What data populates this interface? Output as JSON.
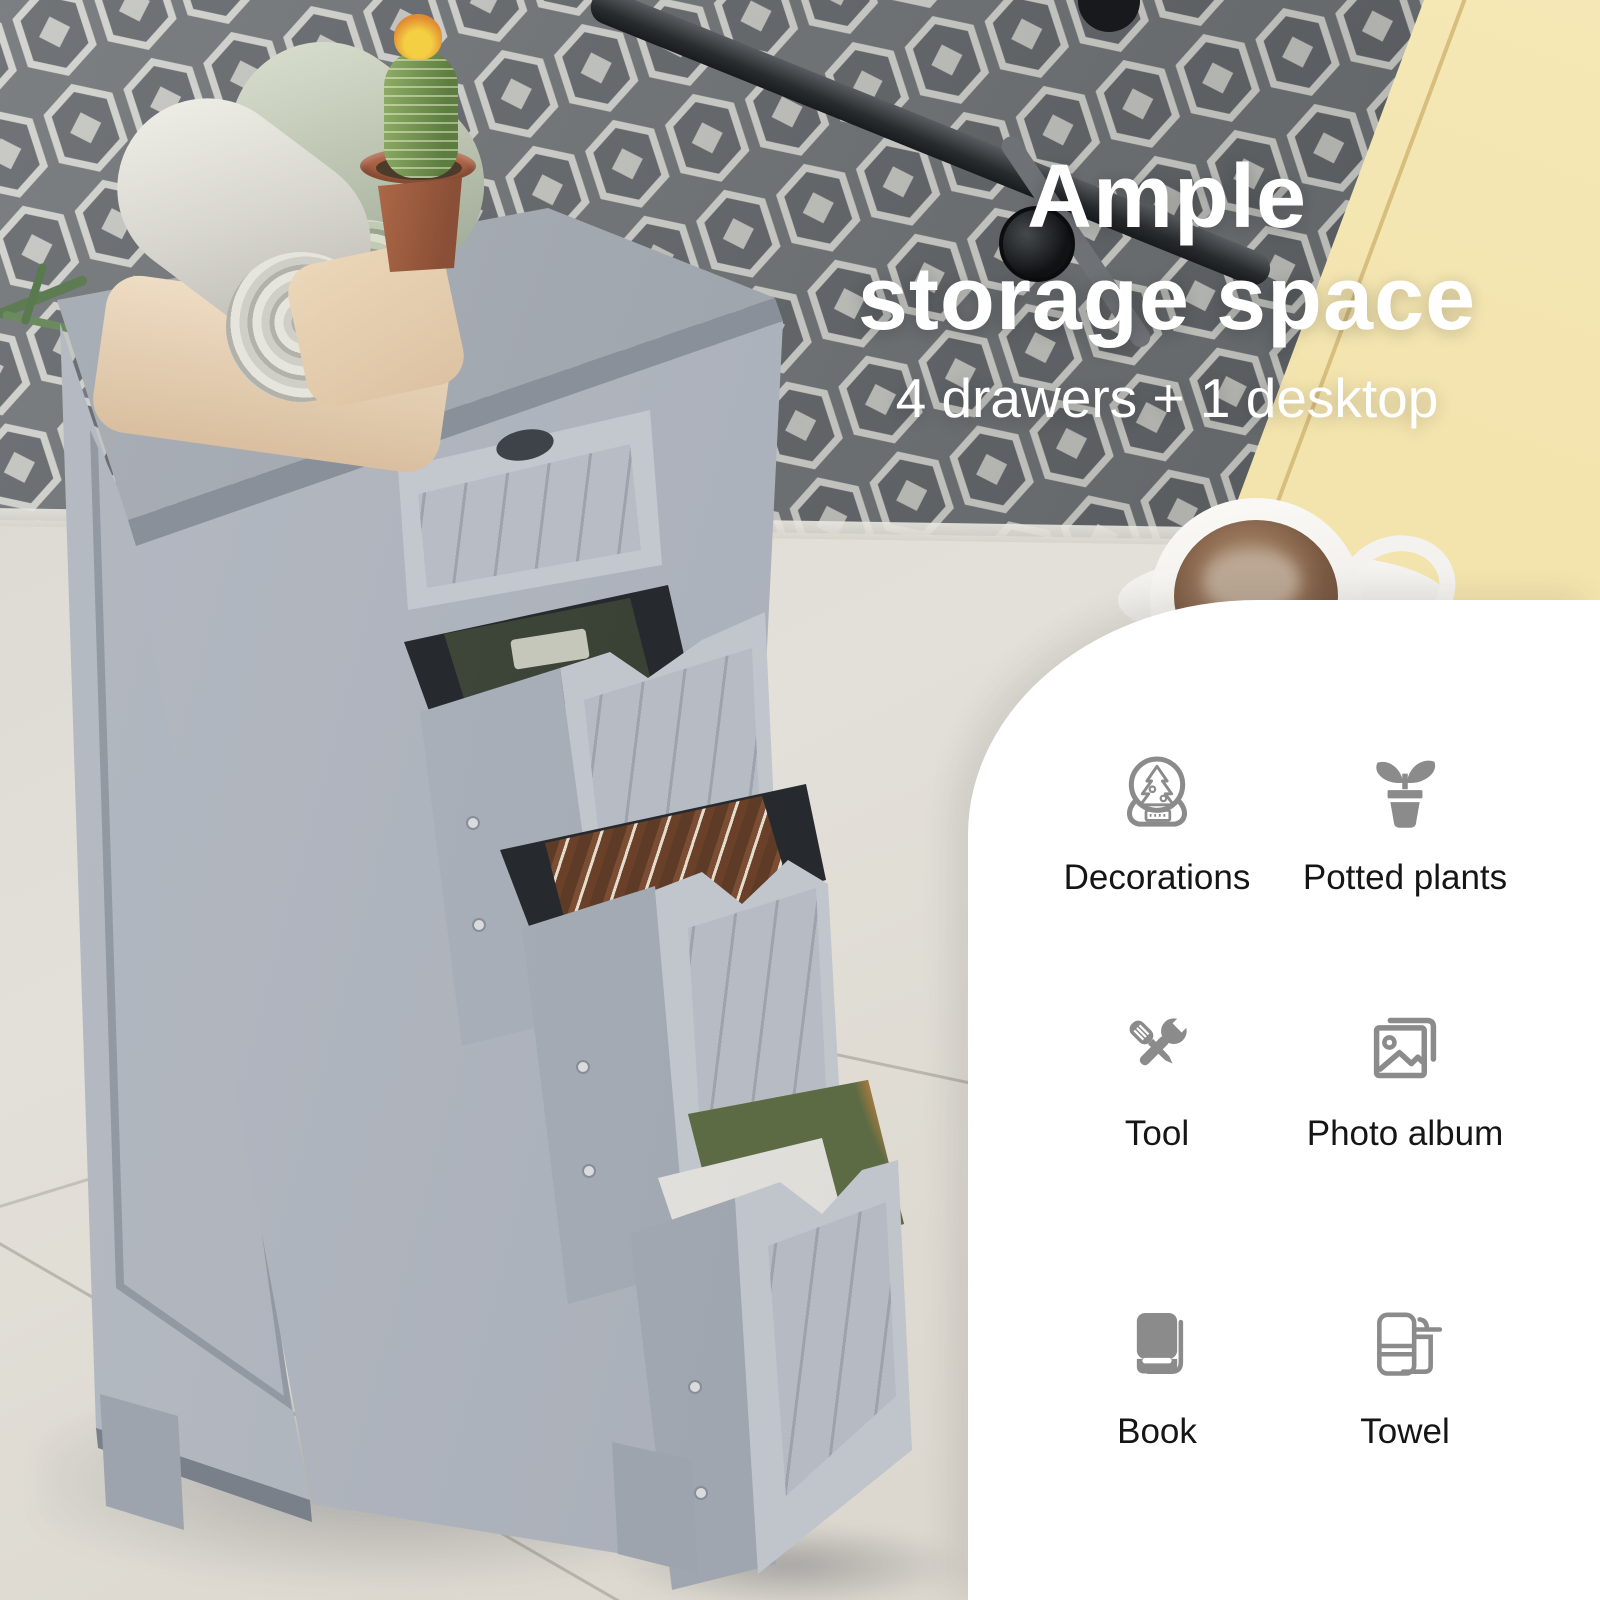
{
  "headline": {
    "line1": "Ample",
    "line2": "storage space",
    "subtitle": "4 drawers + 1 desktop",
    "text_color": "#ffffff"
  },
  "features": {
    "panel_color": "#ffffff",
    "icon_color": "#8b8b8b",
    "label_color": "#151515",
    "items": [
      {
        "icon": "snow-globe-icon",
        "label": "Decorations"
      },
      {
        "icon": "potted-plant-icon",
        "label": "Potted plants"
      },
      {
        "icon": "tool-icon",
        "label": "Tool"
      },
      {
        "icon": "photo-album-icon",
        "label": "Photo album"
      },
      {
        "icon": "book-icon",
        "label": "Book"
      },
      {
        "icon": "towel-icon",
        "label": "Towel"
      }
    ]
  },
  "scene": {
    "palette": {
      "cabinet_grey": "#aeb4bd",
      "rug_grey": "#6d7174",
      "floor_beige": "#ddd9d1",
      "bench_yellow": "#f0dfa4",
      "drawer_cavity": "#26292e"
    }
  }
}
